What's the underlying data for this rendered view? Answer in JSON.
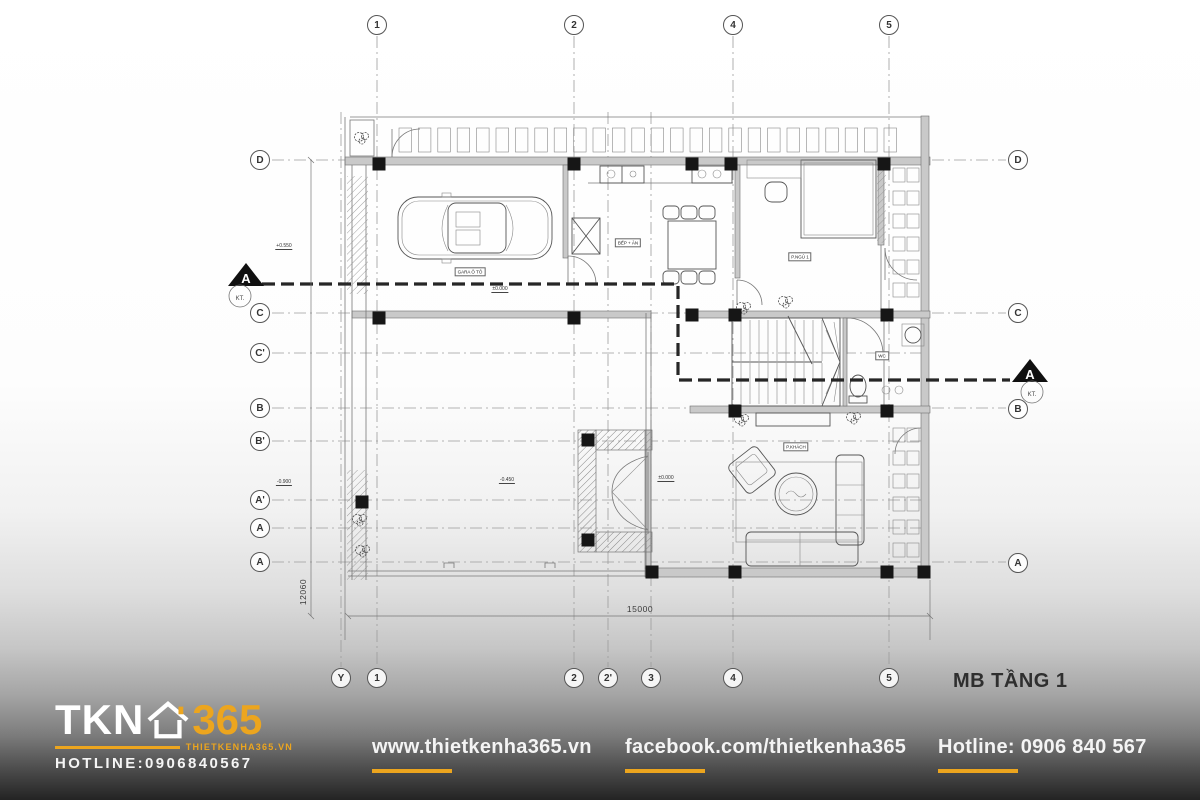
{
  "page": {
    "title": "MB TẦNG 1"
  },
  "colors": {
    "accent": "#ECA51E",
    "drawing_line": "#555555",
    "grid_line": "#9C9C9C",
    "wall_fill": "#C9C9C9",
    "column_fill": "#161616",
    "title_text": "#2F2F2F",
    "footer_text": "#F4F4F4"
  },
  "grid_axes": {
    "top": [
      {
        "label": "1",
        "x": 377
      },
      {
        "label": "2",
        "x": 574
      },
      {
        "label": "4",
        "x": 733
      },
      {
        "label": "5",
        "x": 889
      }
    ],
    "bottom": [
      {
        "label": "Y",
        "x": 341
      },
      {
        "label": "1",
        "x": 377
      },
      {
        "label": "2",
        "x": 574
      },
      {
        "label": "2'",
        "x": 608
      },
      {
        "label": "3",
        "x": 651
      },
      {
        "label": "4",
        "x": 733
      },
      {
        "label": "5",
        "x": 889
      }
    ],
    "left": [
      {
        "label": "D",
        "y": 160
      },
      {
        "label": "C",
        "y": 313
      },
      {
        "label": "C'",
        "y": 353
      },
      {
        "label": "B",
        "y": 408
      },
      {
        "label": "B'",
        "y": 441
      },
      {
        "label": "A'",
        "y": 500
      },
      {
        "label": "A",
        "y": 528
      },
      {
        "label": "A",
        "y": 562
      }
    ],
    "right": [
      {
        "label": "D",
        "y": 160
      },
      {
        "label": "C",
        "y": 313
      },
      {
        "label": "B",
        "y": 409
      },
      {
        "label": "A",
        "y": 563
      }
    ]
  },
  "section_markers": {
    "left": {
      "label": "A",
      "sub": "KT."
    },
    "right": {
      "label": "A",
      "sub": "KT."
    }
  },
  "dimensions": {
    "bottom_total": "15000",
    "left_total": "12060"
  },
  "levels": [
    {
      "text": "±0.000",
      "x": 500,
      "y": 293
    },
    {
      "text": "-0.450",
      "x": 507,
      "y": 484
    },
    {
      "text": "±0.000",
      "x": 666,
      "y": 482
    },
    {
      "text": "+0.550",
      "x": 284,
      "y": 250
    },
    {
      "text": "-0.900",
      "x": 284,
      "y": 486
    }
  ],
  "room_labels": [
    {
      "text": "GARA Ô TÔ",
      "x": 470,
      "y": 272
    },
    {
      "text": "BẾP + ĂN",
      "x": 628,
      "y": 243
    },
    {
      "text": "P.NGỦ 1",
      "x": 800,
      "y": 257
    },
    {
      "text": "WC",
      "x": 882,
      "y": 356
    },
    {
      "text": "P.KHÁCH",
      "x": 796,
      "y": 447
    }
  ],
  "footer": {
    "logo": {
      "name": "TKN",
      "number": "365",
      "website": "THIETKENHA365.VN",
      "hotline": "HOTLINE:0906840567"
    },
    "links": [
      {
        "label": "www.thietkenha365.vn"
      },
      {
        "label": "facebook.com/thietkenha365"
      },
      {
        "label": "Hotline: 0906 840 567"
      }
    ]
  }
}
